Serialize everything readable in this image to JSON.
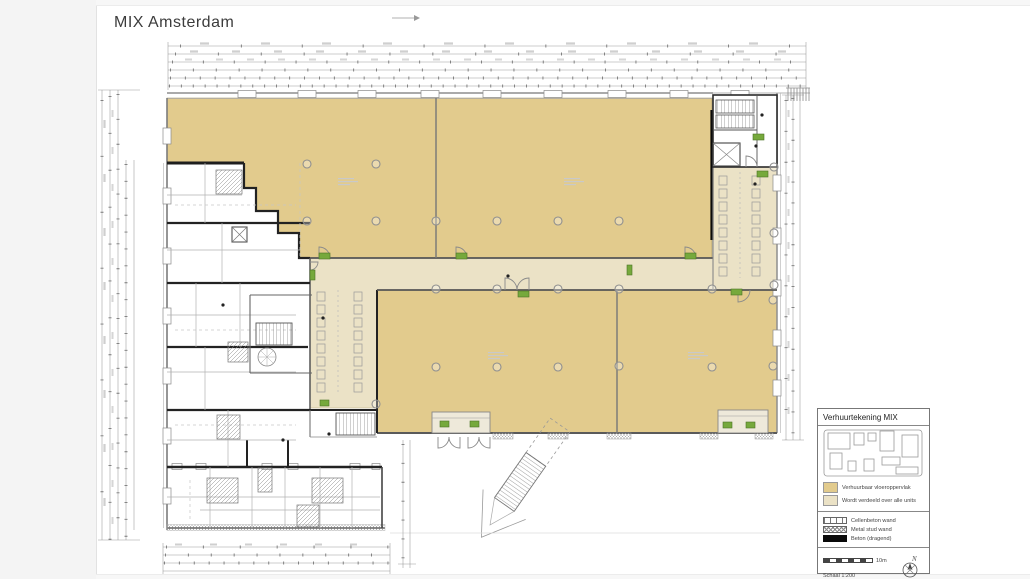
{
  "title": "MIX Amsterdam",
  "colors": {
    "rentable_fill": "#e2cb8d",
    "shared_fill": "#ebe2c6",
    "green_marker": "#76a93c",
    "wall_dark": "#2f2f2f"
  },
  "legend": {
    "title": "Verhuurtekening MIX",
    "area_items": [
      {
        "label": "Verhuurbaar vloeroppervlak",
        "color": "#e2cb8d"
      },
      {
        "label": "Wordt verdeeld over alle units",
        "color": "#ebe2c6"
      }
    ],
    "wall_items": [
      {
        "label": "Cellenbeton wand",
        "style": "cellenbeton"
      },
      {
        "label": "Metal stud wand",
        "style": "metalstud"
      },
      {
        "label": "Beton (dragend)",
        "style": "beton"
      }
    ],
    "scale_bar_label": "10m",
    "scale_text": "Schaal 1:200",
    "paper_text": "Papierformaat A3",
    "north_label": "N"
  }
}
